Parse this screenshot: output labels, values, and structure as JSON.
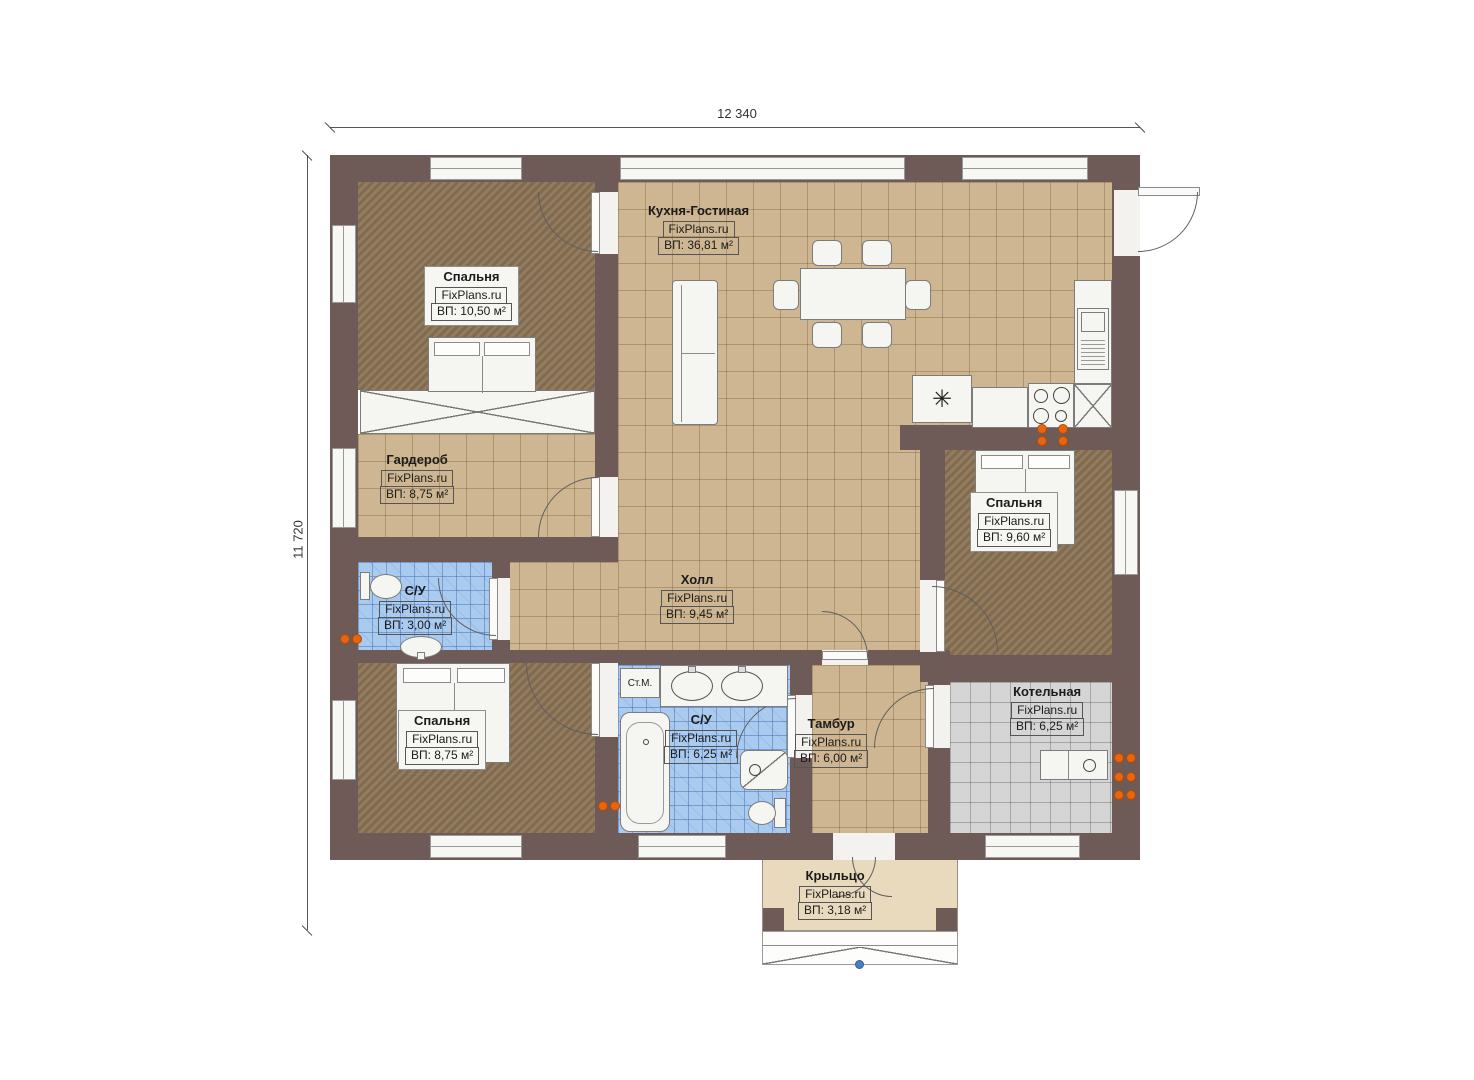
{
  "dimensions": {
    "width_label": "12 340",
    "height_label": "11 720"
  },
  "rooms": [
    {
      "id": "kitchen-living",
      "name": "Кухня-Гостиная",
      "brand": "FixPlans.ru",
      "area": "ВП: 36,81 м²"
    },
    {
      "id": "bedroom-top-left",
      "name": "Спальня",
      "brand": "FixPlans.ru",
      "area": "ВП: 10,50 м²"
    },
    {
      "id": "wardrobe",
      "name": "Гардероб",
      "brand": "FixPlans.ru",
      "area": "ВП: 8,75 м²"
    },
    {
      "id": "bathroom-small",
      "name": "С/У",
      "brand": "FixPlans.ru",
      "area": "ВП: 3,00 м²"
    },
    {
      "id": "bedroom-bottom-left",
      "name": "Спальня",
      "brand": "FixPlans.ru",
      "area": "ВП: 8,75 м²"
    },
    {
      "id": "hall",
      "name": "Холл",
      "brand": "FixPlans.ru",
      "area": "ВП: 9,45 м²"
    },
    {
      "id": "bathroom-main",
      "name": "С/У",
      "brand": "FixPlans.ru",
      "area": "ВП: 6,25 м²"
    },
    {
      "id": "vestibule",
      "name": "Тамбур",
      "brand": "FixPlans.ru",
      "area": "ВП: 6,00 м²"
    },
    {
      "id": "bedroom-right",
      "name": "Спальня",
      "brand": "FixPlans.ru",
      "area": "ВП: 9,60 м²"
    },
    {
      "id": "boiler-room",
      "name": "Котельная",
      "brand": "FixPlans.ru",
      "area": "ВП: 6,25 м²"
    },
    {
      "id": "porch",
      "name": "Крыльцо",
      "brand": "FixPlans.ru",
      "area": "ВП: 3,18 м²"
    }
  ],
  "annotations": {
    "washing_machine": "Ст.М."
  },
  "icons": {
    "sink_star": "✳"
  },
  "colors": {
    "wall": "#6e5b57",
    "tile_tan": "#cdb691",
    "carpet_brown": "#8b7355",
    "tile_blue": "#aacbf0",
    "tile_gray": "#d5d5d5",
    "porch_floor": "#e9dabd",
    "outlet_orange": "#e8650f",
    "marker_blue": "#4a7fc1"
  }
}
